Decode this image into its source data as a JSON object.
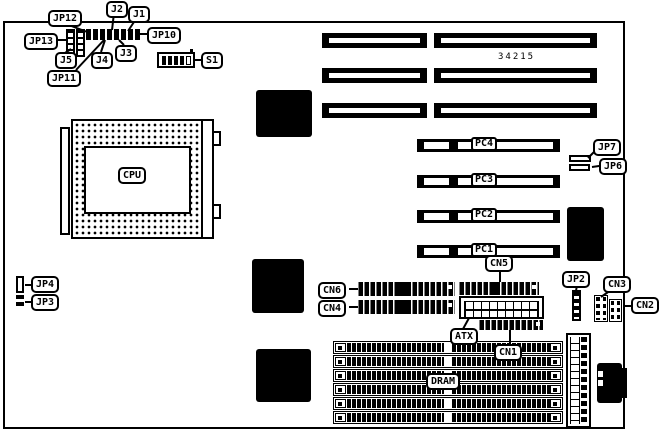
{
  "diagram": {
    "part_number": "34215",
    "colors": {
      "foreground": "#000000",
      "background": "#ffffff"
    },
    "labels": {
      "jp12": "JP12",
      "j2": "J2",
      "j1": "J1",
      "jp13": "JP13",
      "jp10": "JP10",
      "j5": "J5",
      "j4": "J4",
      "j3": "J3",
      "jp11": "JP11",
      "s1": "S1",
      "cpu": "CPU",
      "jp7": "JP7",
      "jp6": "JP6",
      "pc4": "PC4",
      "pc3": "PC3",
      "pc2": "PC2",
      "pc1": "PC1",
      "cn6": "CN6",
      "cn5": "CN5",
      "cn4": "CN4",
      "jp2": "JP2",
      "cn3": "CN3",
      "cn2": "CN2",
      "atx": "ATX",
      "cn1": "CN1",
      "dram": "DRAM",
      "jp4": "JP4",
      "jp3": "JP3"
    }
  }
}
